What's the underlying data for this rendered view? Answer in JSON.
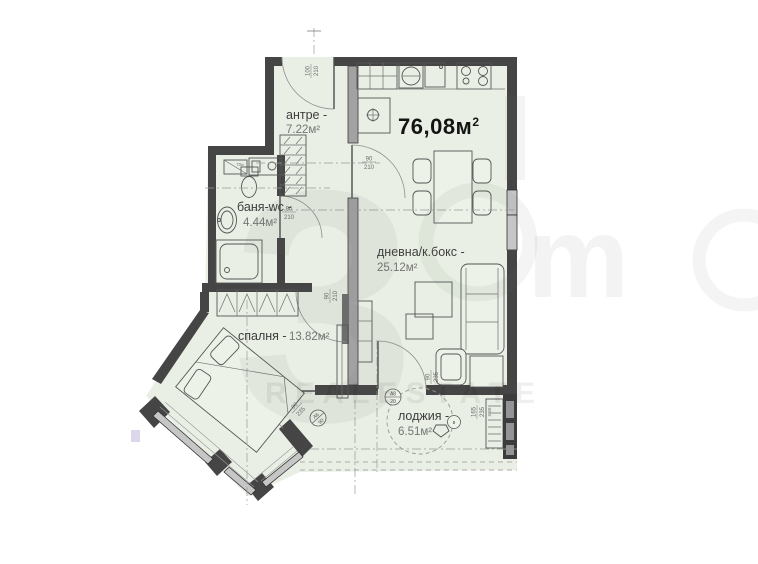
{
  "colors": {
    "floor": "#e9efe4",
    "wall_dark": "#454545",
    "partition_gray": "#a2a2a2",
    "total_text": "#141414"
  },
  "plan": {
    "total_area": {
      "value": "76,08м",
      "sup": "2"
    },
    "rooms": {
      "antre": {
        "name": "антре -",
        "area": "7.22м²"
      },
      "banya": {
        "name": "баня-wc -",
        "area": "4.44м²"
      },
      "spalnya": {
        "name": "спалня -",
        "area": "13.82м²"
      },
      "dnevna": {
        "name": "дневна/к.бокс -",
        "area": "25.12м²"
      },
      "lodzhia": {
        "name": "лоджия -",
        "area": "6.51м²"
      }
    },
    "door_dims": {
      "entrance": {
        "w": "100",
        "h": "210"
      },
      "hall_living": {
        "w": "90",
        "h": "210"
      },
      "bath": {
        "w": "90",
        "h": "210"
      },
      "bedroom": {
        "w": "90",
        "h": "210"
      },
      "bedroom_loggia": {
        "w": "90",
        "h": "235"
      },
      "living_loggia": {
        "w": "90",
        "h": "235"
      },
      "loggia_window": {
        "w": "165",
        "h": "235",
        "note": "п.40"
      }
    },
    "notes": {
      "washer": "70⌀"
    },
    "symbols": {
      "s1": {
        "top": "А6",
        "bot": "90"
      },
      "s2": {
        "top": "А8",
        "bot": "20"
      },
      "s3": {
        "label": "в"
      }
    },
    "watermark": {
      "glyph": "3",
      "glyph2": "m",
      "band": "R E A L   E S T A T E"
    }
  }
}
